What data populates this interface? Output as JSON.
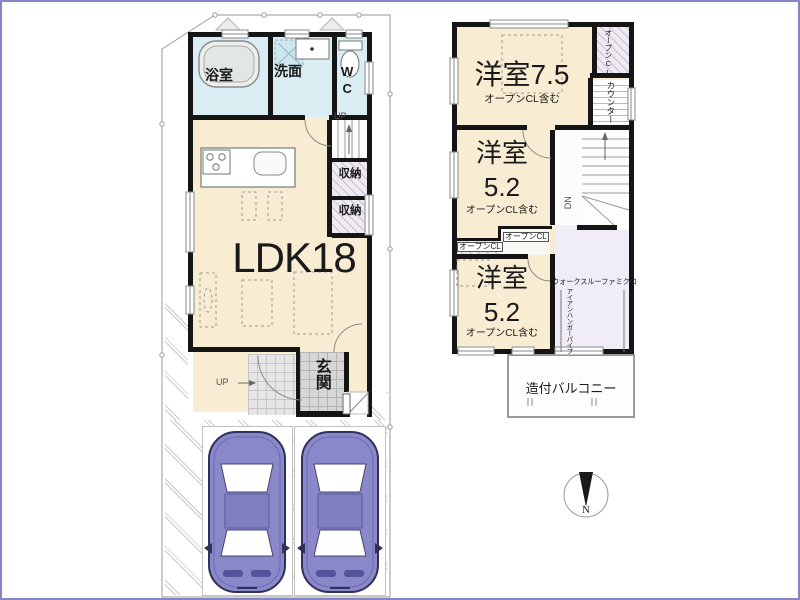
{
  "floor1": {
    "bath": "浴室",
    "washroom": "洗面",
    "wc": "WC",
    "stairs_up": "UP",
    "storage_upper": "収納",
    "storage_lower": "収納",
    "ldk": "LDK18",
    "entrance": "玄関",
    "approach_up": "UP"
  },
  "floor2": {
    "bedroom_top": "洋室7.5",
    "bedroom_top_note": "オープンCL含む",
    "open_closet_top": "オープンCL",
    "counter": "カウンター",
    "bedroom_mid": "洋室",
    "bedroom_mid_size": "5.2",
    "bedroom_mid_note": "オープンCL含む",
    "open_closet_left": "オープンCL",
    "open_closet_right": "オープンCL",
    "stairs_down": "DN",
    "bedroom_bottom": "洋室",
    "bedroom_bottom_size": "5.2",
    "bedroom_bottom_note": "オープンCL含む",
    "walkthrough_closet": "ウォークスルーファミクロ",
    "hanger_pipe": "アイアンハンガーパイプ",
    "balcony": "造付バルコニー"
  },
  "compass": {
    "north": "N"
  },
  "colors": {
    "room_cream": "#f8edd2",
    "wet_blue": "#d9edf2",
    "wall_black": "#151515",
    "hall_lavender": "#f0edf6",
    "car_body": "#8a88c8",
    "tile_gray": "#d7d7d7",
    "frame_blue": "#8585c4"
  }
}
